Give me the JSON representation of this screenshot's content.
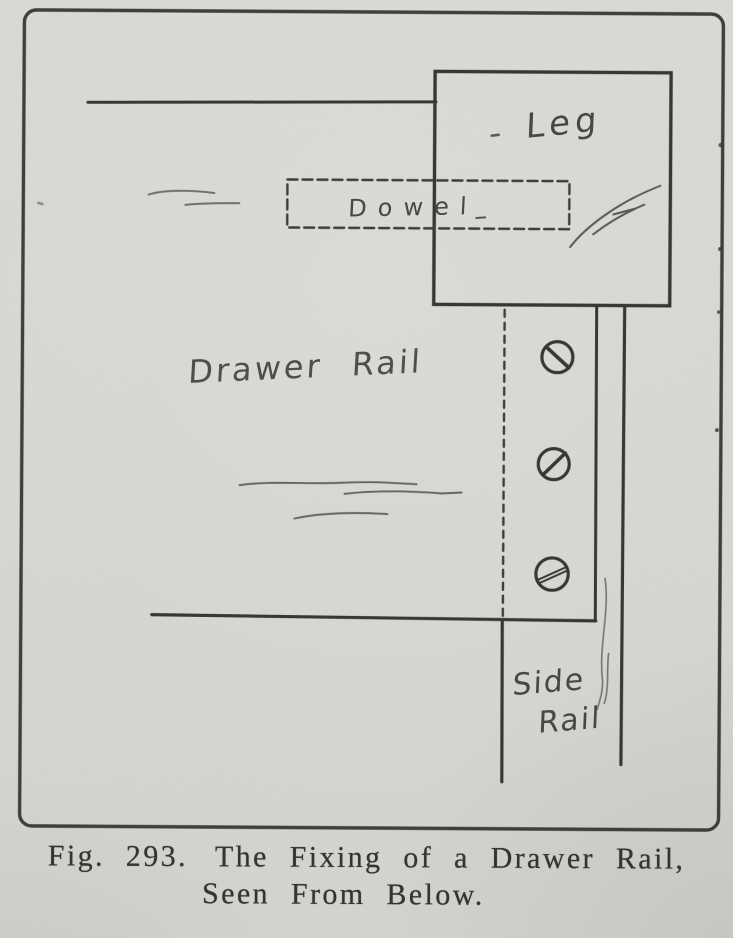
{
  "page": {
    "colors": {
      "paper": "#d7d7d4",
      "ink": "#34342e",
      "pencil": "#6b6b62"
    }
  },
  "diagram": {
    "labels": {
      "leg": "Leg",
      "dowel": "Dowel",
      "drawer_rail": "Drawer Rail",
      "side_rail_line1": "Side",
      "side_rail_line2": "Rail"
    },
    "screw_count": 3
  },
  "caption": {
    "fig_label": "Fig. 293.",
    "title_line1": "The Fixing of a Drawer Rail,",
    "title_line2": "Seen From Below."
  }
}
